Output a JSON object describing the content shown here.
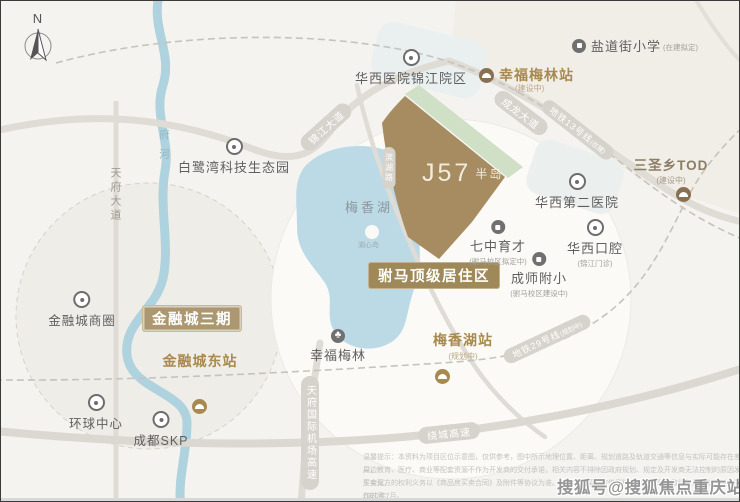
{
  "compass": {
    "label": "N"
  },
  "site": {
    "logo_main": "J57",
    "logo_sub": "半岛"
  },
  "banners": {
    "residence": "驸马顶级居住区",
    "financial_city": "金融城三期"
  },
  "roads": {
    "tianfu_avenue": "天府大道",
    "jinjiang_avenue": "锦江大道",
    "chenglong_avenue": "成龙大道",
    "binhu_road": "滨湖路",
    "airport_expwy": "天府国际机场高速",
    "ring_expwy": "绕城高速",
    "metro13": "地铁13号线",
    "metro13_note": "(在建)",
    "metro29": "地铁29号线",
    "metro29_note": "(规划中)",
    "fu_river": "府河"
  },
  "water": {
    "lake": "梅香湖",
    "island": "湖心岛"
  },
  "pois": [
    {
      "label": "华西医院锦江院区",
      "sub": ""
    },
    {
      "label": "盐道街小学",
      "sub": "(在建拟定)"
    },
    {
      "label": "幸福梅林站",
      "sub": "(建设中)"
    },
    {
      "label": "三圣乡TOD",
      "sub": "(建设中)"
    },
    {
      "label": "华西第二医院",
      "sub": ""
    },
    {
      "label": "华西口腔",
      "sub": "(锦江门诊)"
    },
    {
      "label": "七中育才",
      "sub": "(驸马校区拟定中)"
    },
    {
      "label": "成师附小",
      "sub": "(驸马校区建设中)"
    },
    {
      "label": "白鹭湾科技生态园",
      "sub": ""
    },
    {
      "label": "幸福梅林",
      "sub": ""
    },
    {
      "label": "梅香湖站",
      "sub": "(规划中)"
    },
    {
      "label": "金融城东站",
      "sub": ""
    },
    {
      "label": "金融城商圈",
      "sub": ""
    },
    {
      "label": "环球中心",
      "sub": ""
    },
    {
      "label": "成都SKP",
      "sub": ""
    }
  ],
  "watermark": "搜狐号@搜狐焦点重庆站",
  "disclaimer": {
    "lines": [
      "温馨提示：本资料为项目区位示意图，仅供参考，图中所示地理位置、距离、规划道路及轨道交通等信息与实际可能存在差异，",
      "周边教育、医疗、商业等配套资源不作为开发商的交付承诺，相关内容不排除因政府规划、规定及开发商无法控制的原因发生变化，",
      "买卖双方的权利义务以《商品房买卖合同》及附件等协议为准。开发商保留对宣传资料修改的权利，敬请留意最新资料。制作时间：",
      "2020年7月。"
    ]
  },
  "colors": {
    "accent_gold": "#a8894e",
    "banner_brown": "#9f8959",
    "banner_tan": "#ac9870",
    "site_brown": "#a68c60",
    "site_green": "#cfe0c6",
    "water_blue": "#bcdae6",
    "label_gray": "#5f5f5f"
  }
}
